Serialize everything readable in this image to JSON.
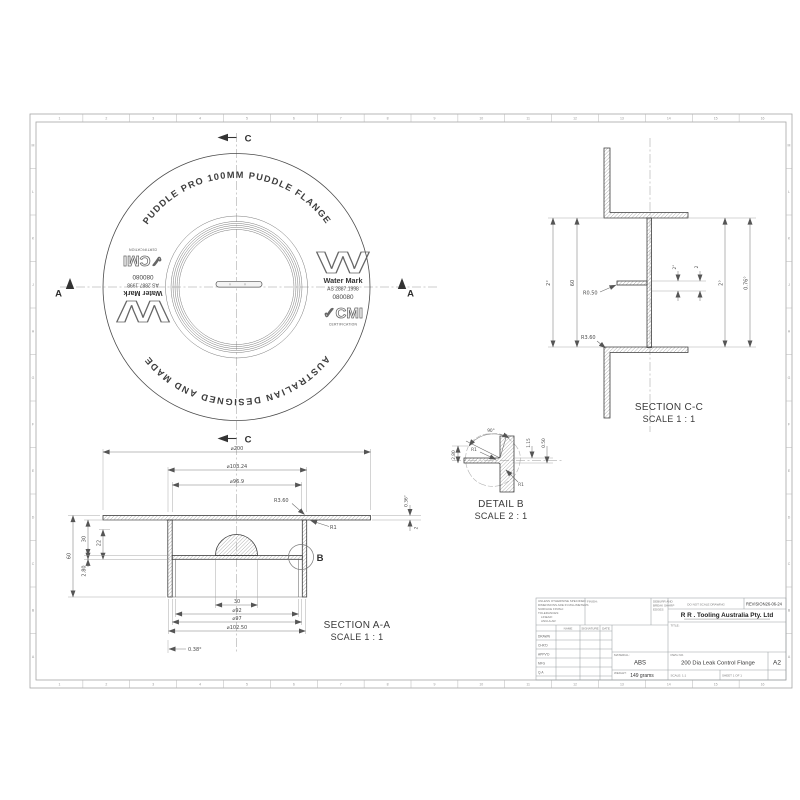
{
  "palette": {
    "line": "#3c3c3c",
    "background": "#ffffff"
  },
  "sheet": {
    "zones_h": [
      "1",
      "2",
      "3",
      "4",
      "5",
      "6",
      "7",
      "8",
      "9",
      "10",
      "11",
      "12",
      "13",
      "14",
      "15",
      "16"
    ],
    "zones_v": [
      "M",
      "L",
      "K",
      "J",
      "H",
      "G",
      "F",
      "E",
      "D",
      "C",
      "B",
      "A"
    ]
  },
  "drawing": {
    "top_view": {
      "arc_text_top": "PUDDLE PRO 100MM PUDDLE FLANGE",
      "arc_text_bottom": "AUSTRALIAN DESIGNED AND MADE",
      "watermark": {
        "logo_letter": "W",
        "name": "Water Mark",
        "standard": "AS 2887:1998",
        "licence": "080080",
        "cmi": "✓CMI",
        "certification": "CERTIFICATION"
      },
      "section_marker_c": "C",
      "section_marker_a": "A"
    },
    "section_cc": {
      "title": "SECTION C-C",
      "scale": "SCALE 1 : 1",
      "dims": {
        "outer_left": "2°",
        "height": "60",
        "fillet_small": "R0.50",
        "fillet_large": "R3.60",
        "tab_depth": "2°",
        "tab_thickness": "2",
        "inner_right": "2°",
        "draft_right": "0.76°"
      }
    },
    "detail_b": {
      "title": "DETAIL B",
      "scale": "SCALE 2 : 1",
      "dims": {
        "angle": "90°",
        "radius_top": "R1",
        "radius_bottom": "R1",
        "offset": "1.15",
        "gap": "0.50",
        "thickness": "2.80"
      }
    },
    "section_aa": {
      "title": "SECTION A-A",
      "scale": "SCALE 1 : 1",
      "label_b": "B",
      "dims": {
        "d200": "⌀200",
        "d103": "⌀103.24",
        "d969": "⌀96.9",
        "h60": "60",
        "h30": "30",
        "h22": "22",
        "t280": "2.80",
        "w30": "30",
        "d92": "⌀92",
        "d97": "⌀97",
        "d10250": "⌀102.50",
        "draft": "0.38°",
        "r360": "R3.60",
        "r1": "R1",
        "right_draft": "0.36°",
        "right_t": "2"
      }
    }
  },
  "title_block": {
    "tolerance_lines": [
      "UNLESS OTHERWISE SPECIFIED:",
      "DIMENSIONS ARE IN MILLIMETERS",
      "SURFACE FINISH:",
      "TOLERANCES:",
      "LINEAR:",
      "ANGULAR:"
    ],
    "finish_label": "FINISH:",
    "deburr_lines": [
      "DEBURR AND",
      "BREAK SHARP",
      "EDGES"
    ],
    "do_not_scale": "DO NOT SCALE DRAWING",
    "revision": "REVISION26-06-24",
    "company": "R R .  Tooling Australia Pty. Ltd",
    "title_label": "TITLE:",
    "sign_table": {
      "headers": [
        "NAME",
        "SIGNATURE",
        "DATE"
      ],
      "rows": [
        "DRAWN",
        "CHK'D",
        "APPV'D",
        "MFG",
        "Q.A"
      ]
    },
    "material_label": "MATERIAL:",
    "material": "ABS",
    "weight_label": "WEIGHT:",
    "weight": "149 grams",
    "dwg_label": "DWG NO.",
    "drawing_title": "200 Dia Leak Control Flange",
    "size": "A2",
    "scale_label": "SCALE: 1:1",
    "sheet_label": "SHEET 1 OF 1"
  }
}
